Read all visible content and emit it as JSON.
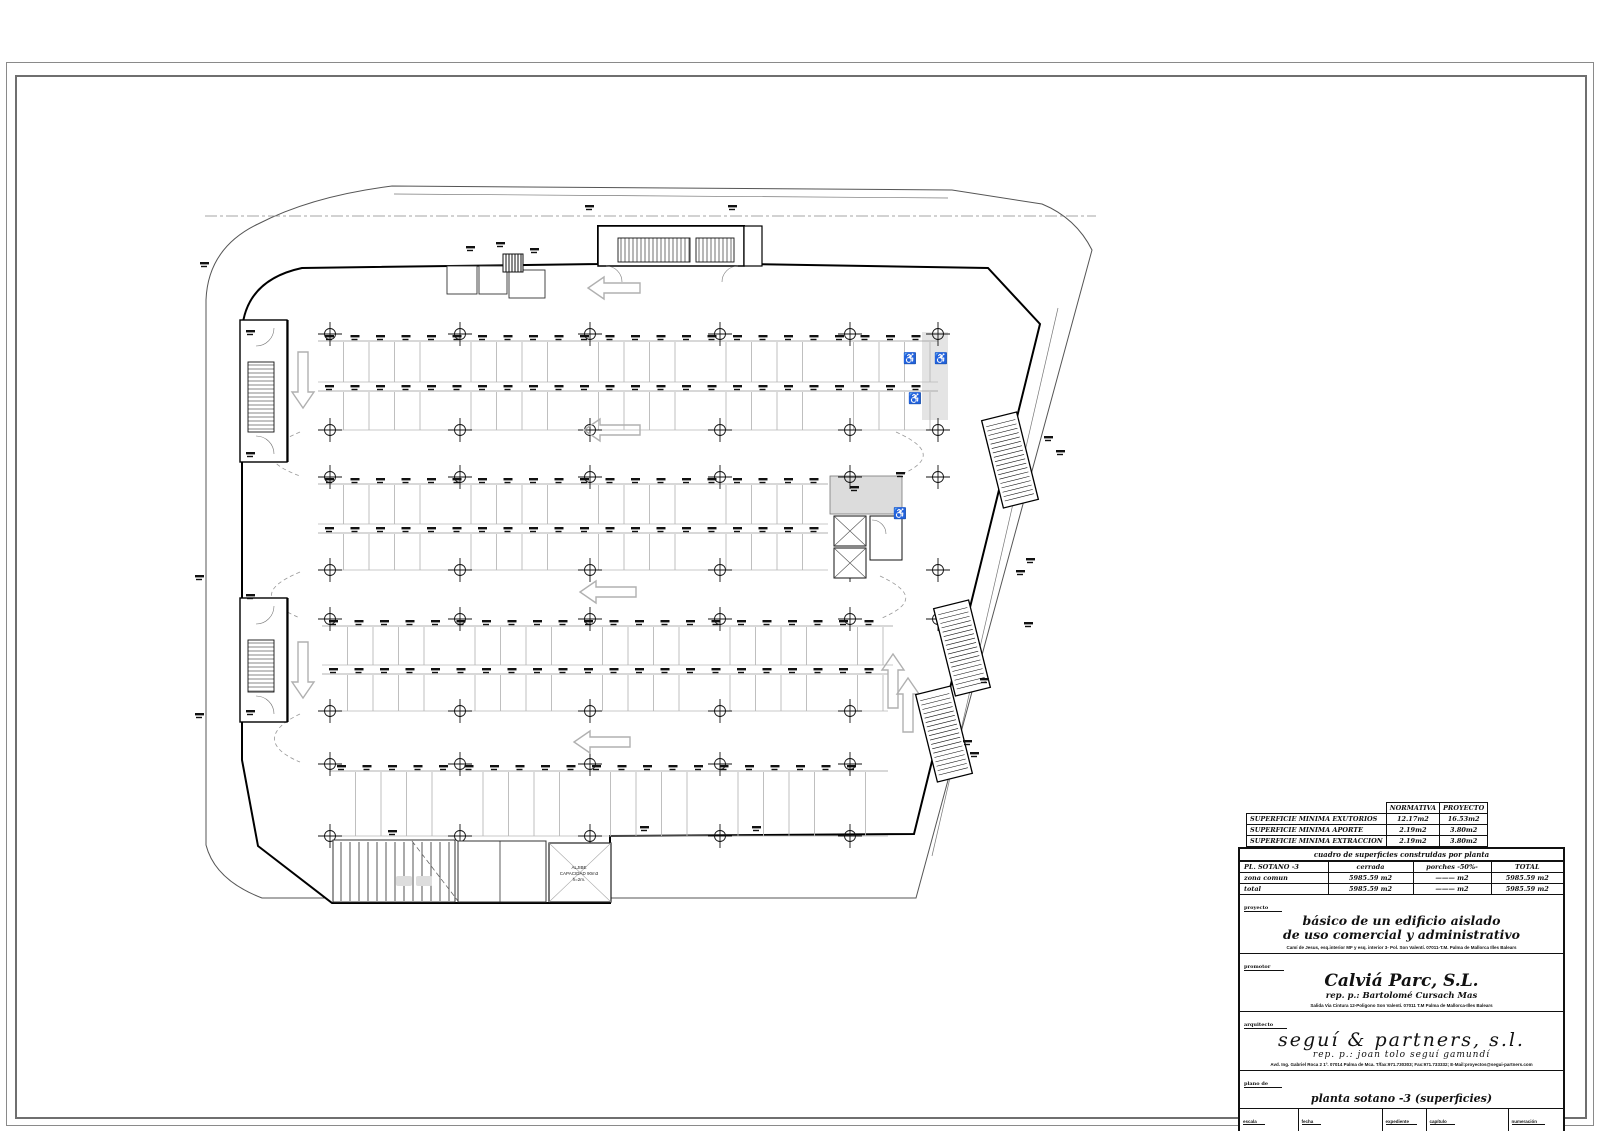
{
  "title_block": {
    "ventilation_table": {
      "headers": [
        "NORMATIVA",
        "PROYECTO"
      ],
      "rows": [
        {
          "label": "SUPERFICIE MINIMA EXUTORIOS",
          "normativa": "12.17m2",
          "proyecto": "16.53m2"
        },
        {
          "label": "SUPERFICIE MINIMA APORTE",
          "normativa": "2.19m2",
          "proyecto": "3.80m2"
        },
        {
          "label": "SUPERFICIE MINIMA EXTRACCION",
          "normativa": "2.19m2",
          "proyecto": "3.80m2"
        }
      ]
    },
    "areas_table": {
      "caption": "cuadro de superficies  construidas por planta",
      "headers": [
        "PL. SOTANO -3",
        "cerrada",
        "porches -50%-",
        "TOTAL"
      ],
      "rows": [
        [
          "zona comun",
          "5985.59 m2",
          "——— m2",
          "5985.59 m2"
        ],
        [
          "total",
          "5985.59 m2",
          "——— m2",
          "5985.59 m2"
        ]
      ]
    },
    "proyecto": {
      "label": "proyecto",
      "title_line1": "básico de un edificio aislado",
      "title_line2": "de uso comercial y administrativo",
      "address": "Camí de Jesus, esq.interior MF y esq. interior 3- Pol. Son Valentí.  07011-T.M. Palma de Mallorca Illes Balears"
    },
    "promotor": {
      "label": "promotor",
      "name": "Calviá Parc, S.L.",
      "rep": "rep. p.: Bartolomé Cursach Mas",
      "address": "Salida Via Cintura 12-Poligono Son Valentí.  07011 T.M Palma de Mallorca-Illes Balears"
    },
    "arquitecto": {
      "label": "arquitecto",
      "name": "seguí & partners, s.l.",
      "rep": "rep. p.: joan tolo seguí gamundí",
      "contact": "Avd. Ing. Gabriel Roca 2 1º. 07014 Palma de Mca. T/fax:971.730303; Fax:971.733332; E-Mail:proyectos@segui-partners.com"
    },
    "plano": {
      "label": "plano de",
      "name": "planta sotano -3 (superficies)"
    },
    "footer": {
      "cells": [
        {
          "label": "escala",
          "value": "1/200"
        },
        {
          "label": "fecha",
          "value": "25 JULIO 05"
        },
        {
          "label": "expediente",
          "value": "04/048"
        },
        {
          "label": "capítulo",
          "value": "SUPERFICIES"
        },
        {
          "label": "numeración",
          "value": "III - 01"
        }
      ]
    }
  },
  "plan": {
    "aljibe": {
      "line1": "ALJIBE",
      "line2": "CAPACIDAD  90m3",
      "line3": "h=2m."
    },
    "wheelchair_icon": "♿"
  },
  "colors": {
    "ink": "#111111",
    "wall": "#000000",
    "light": "#b8b8b8",
    "site": "#555555"
  }
}
